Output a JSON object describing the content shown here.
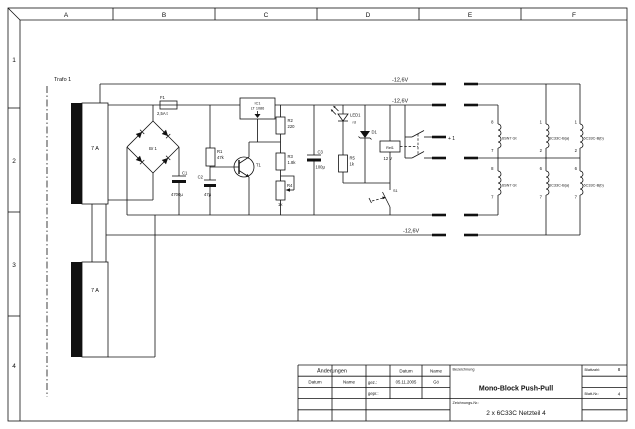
{
  "frame": {
    "cols": [
      "A",
      "B",
      "C",
      "D",
      "E",
      "F"
    ],
    "rows": [
      "1",
      "2",
      "3",
      "4"
    ]
  },
  "schematic": {
    "trafo_label": "Trafo 1",
    "windings": [
      "7 A",
      "7 A"
    ],
    "fuse": {
      "ref": "F1",
      "value": "2,5A t"
    },
    "bridge_ref": "Br 1",
    "c1": {
      "ref": "C1",
      "value": "4700µ"
    },
    "c2": {
      "ref": "C2",
      "value": "47µ"
    },
    "c3": {
      "ref": "C3",
      "value": "100µ"
    },
    "r1": {
      "ref": "R1",
      "value": "47k"
    },
    "r2": {
      "ref": "R2",
      "value": "220"
    },
    "r3": {
      "ref": "R3",
      "value": "1.8k"
    },
    "r4": {
      "ref": "R4",
      "value": "1k"
    },
    "r5": {
      "ref": "R5",
      "value": "1k"
    },
    "ic1": {
      "ref": "IC1",
      "value": "LT 1086"
    },
    "t1_ref": "T1",
    "led": {
      "ref": "LED1",
      "value": "rd"
    },
    "d1_ref": "D1",
    "relay": {
      "ref": "Rel1",
      "value": "12 V"
    },
    "s1_ref": "S1",
    "rails": [
      "-12,6V",
      "-12,6V",
      "-12,6V"
    ],
    "plus_one": "+ 1",
    "tubes": {
      "sn7_label": "6SN7 Gt",
      "sn7_pins": [
        "8",
        "7"
      ],
      "c33_a_label": "6C33C-B(a)",
      "c33_b_label": "6C33C-B(b)",
      "c33_pins_upper": [
        "1",
        "2"
      ],
      "c33_pins_lower": [
        "6",
        "7"
      ]
    }
  },
  "titleblock": {
    "aenderungen": "Änderungen",
    "datum": "Datum",
    "name": "Name",
    "gez": "gez.:",
    "gepr": "gepr.:",
    "date_value": "05.11.2005",
    "name_value": "Gö",
    "bezeichnung": "Bezeichnung",
    "title": "Mono-Block Push-Pull",
    "zeichnungs_nr": "Zeichnungs-Nr.:",
    "drawing_number": "2 x 6C33C  Netzteil 4",
    "blattzahl": "Blattzahl:",
    "blattzahl_value": "8",
    "blatt_nr": "Blatt-Nr.:",
    "blatt_nr_value": "4"
  }
}
